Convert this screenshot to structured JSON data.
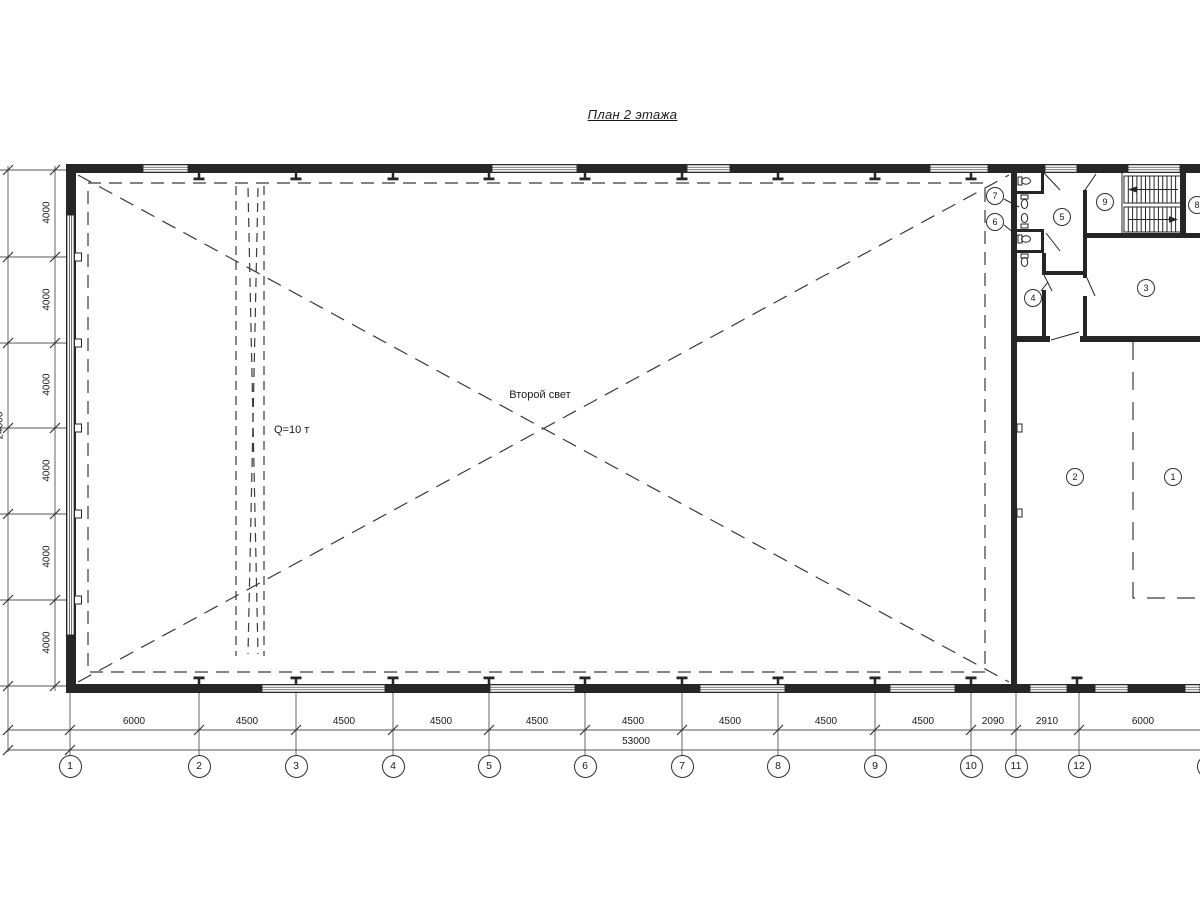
{
  "title": "План 2 этажа",
  "annotations": {
    "second_light": "Второй свет",
    "crane_capacity": "Q=10 т"
  },
  "dimensions": {
    "bottom": {
      "segments": [
        "6000",
        "4500",
        "4500",
        "4500",
        "4500",
        "4500",
        "4500",
        "4500",
        "4500",
        "2090",
        "2910",
        "6000"
      ],
      "total": "53000"
    },
    "left": {
      "segments": [
        "4000",
        "4000",
        "4000",
        "4000",
        "4000",
        "4000"
      ],
      "total": "24000"
    }
  },
  "axes": [
    "1",
    "2",
    "3",
    "4",
    "5",
    "6",
    "7",
    "8",
    "9",
    "10",
    "11",
    "12",
    "13"
  ],
  "rooms": [
    "1",
    "2",
    "3",
    "4",
    "5",
    "6",
    "7",
    "8",
    "9"
  ]
}
